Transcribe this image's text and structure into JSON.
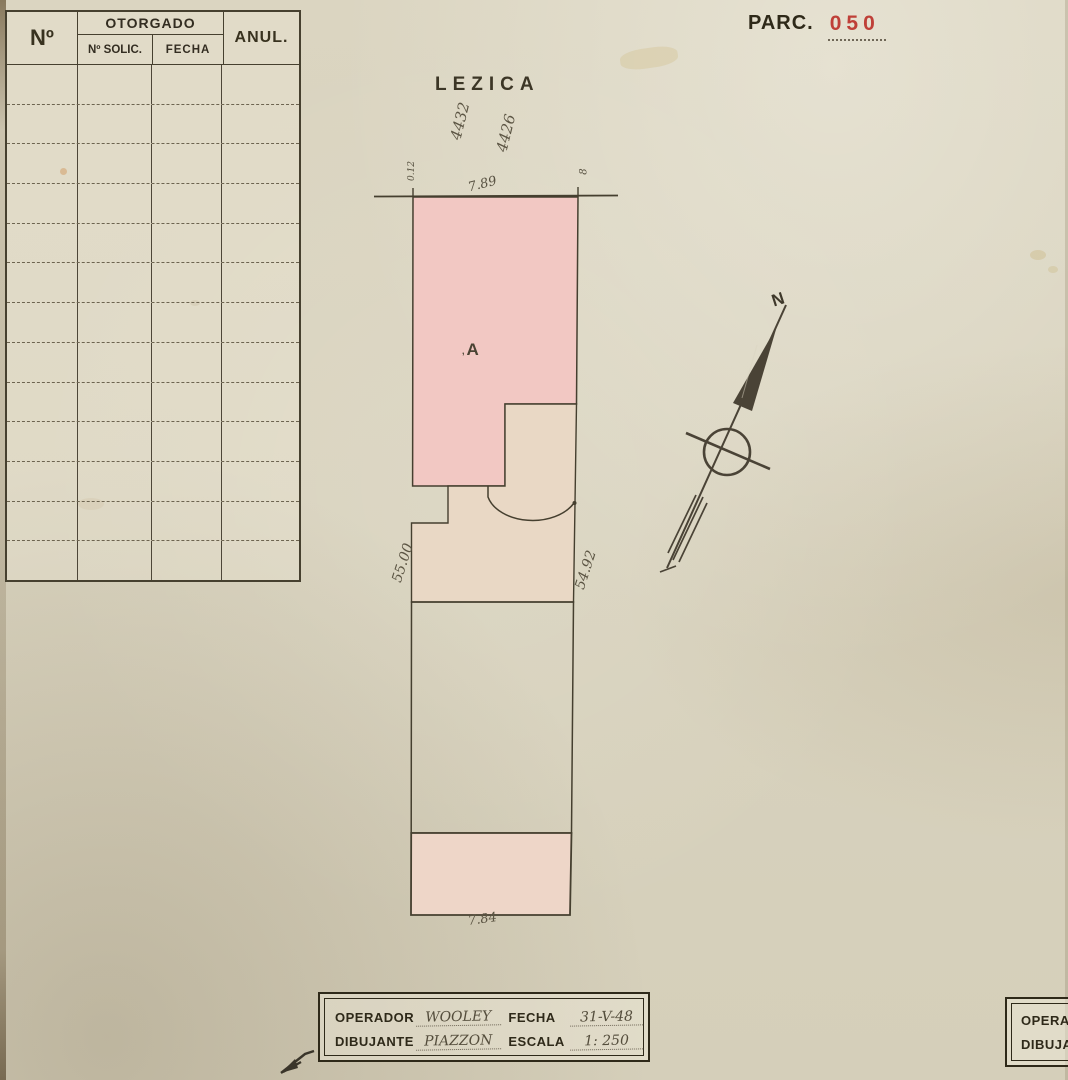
{
  "colors": {
    "red": "#bf4038",
    "ink": "#453f2f",
    "pink_building": "#f2c8c3",
    "pink_patio": "#e9d8c5",
    "pink_rear": "#eed6c8"
  },
  "header_right": {
    "label": "PARC.",
    "number": "050"
  },
  "registry_table": {
    "col_no": "Nº",
    "col_group": "OTORGADO",
    "col_solic": "Nº SOLIC.",
    "col_fecha": "FECHA",
    "col_anul": "ANUL.",
    "row_count": 13
  },
  "plan": {
    "street_name": "LEZICA",
    "street_number_left": "4432",
    "street_number_right": "4426",
    "front_dim_left": "0.12",
    "front_dim_center": "7.89",
    "front_dim_right": "8",
    "side_dim_left": "55.00",
    "side_dim_right": "54.92",
    "rear_dim": "7.84",
    "building_label": "A"
  },
  "compass": {
    "north": "N"
  },
  "title_block": {
    "operador_label": "OPERADOR",
    "operador_value": "WOOLEY",
    "fecha_label": "FECHA",
    "fecha_value": "31-V-48",
    "dibujante_label": "DIBUJANTE",
    "dibujante_value": "PIAZZON",
    "escala_label": "ESCALA",
    "escala_value": "1: 250"
  },
  "title_block_corner": {
    "operador_label": "OPERADOR",
    "dibujante_label": "DIBUJANTE"
  }
}
